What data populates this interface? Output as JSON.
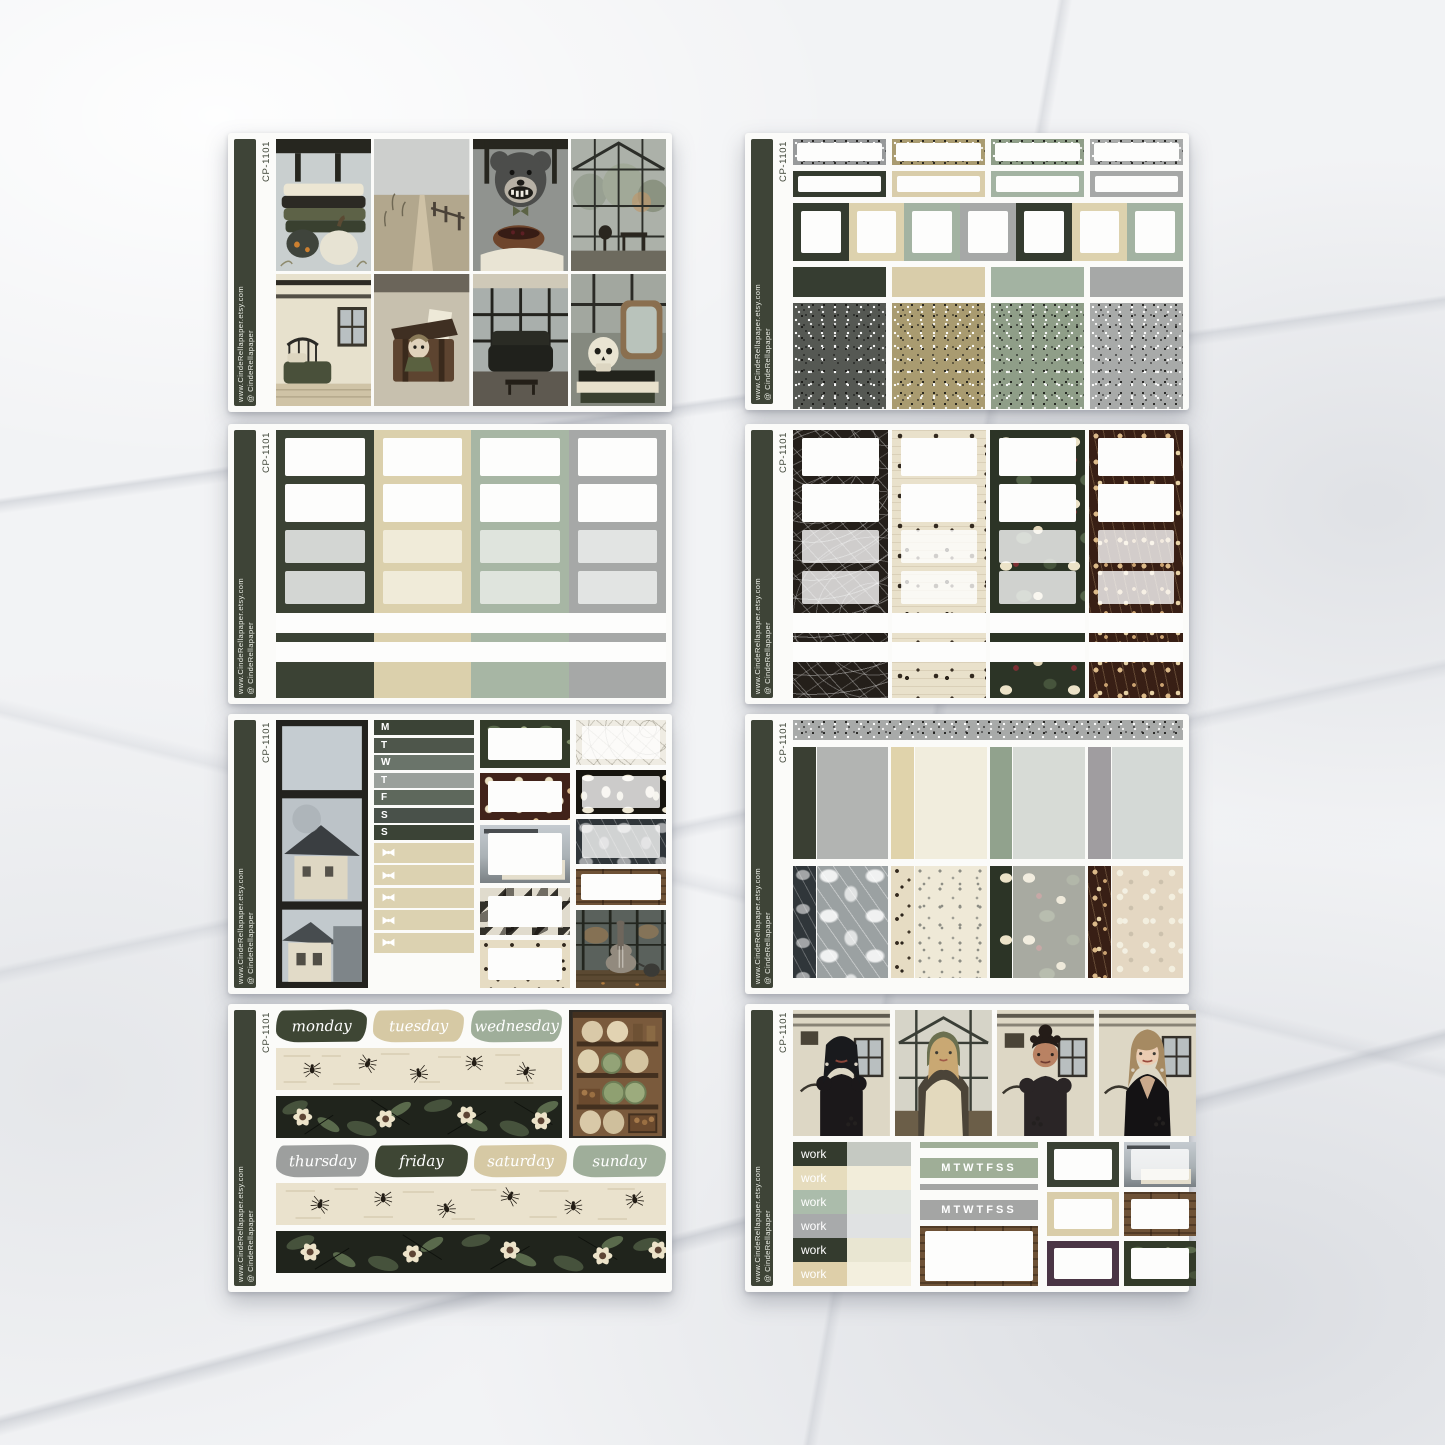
{
  "product": {
    "code": "CP-1101",
    "shop_url": "www.CindeRellapaper.etsy.com",
    "shop_handle": "@ CindeRellapaper"
  },
  "palette": {
    "dark_green": "#3b4234",
    "tan": "#dbd0ac",
    "sage": "#a7b6a4",
    "gray": "#a6a8a7",
    "plum": "#4a3545",
    "cream": "#efe9d7",
    "sidebar_green": "#3e4437"
  },
  "sheet5": {
    "day_letters": [
      "M",
      "T",
      "W",
      "T",
      "F",
      "S",
      "S"
    ]
  },
  "sheet7": {
    "days_top": [
      "monday",
      "tuesday",
      "wednesday"
    ],
    "days_bottom": [
      "thursday",
      "friday",
      "saturday",
      "sunday"
    ]
  },
  "sheet8": {
    "work_labels": [
      "work",
      "work",
      "work",
      "work",
      "work",
      "work"
    ],
    "mini_week_top": "MTWTFSS",
    "mini_week_bottom": "MTWTFSS"
  }
}
